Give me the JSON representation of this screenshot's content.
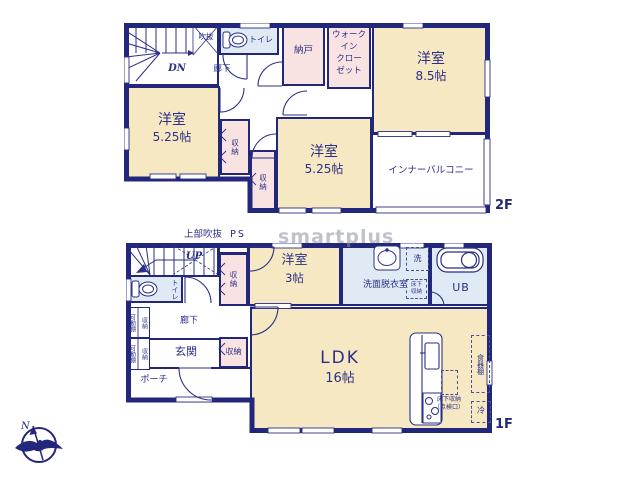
{
  "watermark": "smartplus",
  "compass": {
    "n": "N"
  },
  "f2": {
    "tag": "2F",
    "dn": "DN",
    "void": "吹抜",
    "hall": "廊下",
    "toilet": "トイレ",
    "nando": "納戸",
    "wic1": "ウォーク",
    "wic2": "イン",
    "wic3": "クロー",
    "wic4": "ゼット",
    "r85n": "洋室",
    "r85s": "8.5帖",
    "balcony": "インナーバルコニー",
    "r525an": "洋室",
    "r525as": "5.25帖",
    "r525bn": "洋室",
    "r525bs": "5.25帖",
    "clo1": "収納",
    "clo2": "収納"
  },
  "f1": {
    "tag": "1F",
    "upper_void": "上部吹抜",
    "ps": "PS",
    "up": "UP",
    "clo_hall": "収納",
    "r3n": "洋室",
    "r3s": "3帖",
    "washroom": "洗面脱衣室",
    "washer": "洗",
    "underfloor_a": "床下収納",
    "ub": "UB",
    "toilet": "トイレ",
    "shelf_a": "可動棚",
    "shelf_a2": "収納",
    "shelf_b": "可動棚",
    "shelf_b2": "収納",
    "hall": "廊下",
    "genkan": "玄関",
    "clo_ent": "収納",
    "porch": "ポーチ",
    "ldkn": "LDK",
    "ldks": "16帖",
    "uf_b1": "床下収納",
    "uf_b2": "（点検口）",
    "cupboard": "食器棚",
    "fridge": "冷"
  }
}
